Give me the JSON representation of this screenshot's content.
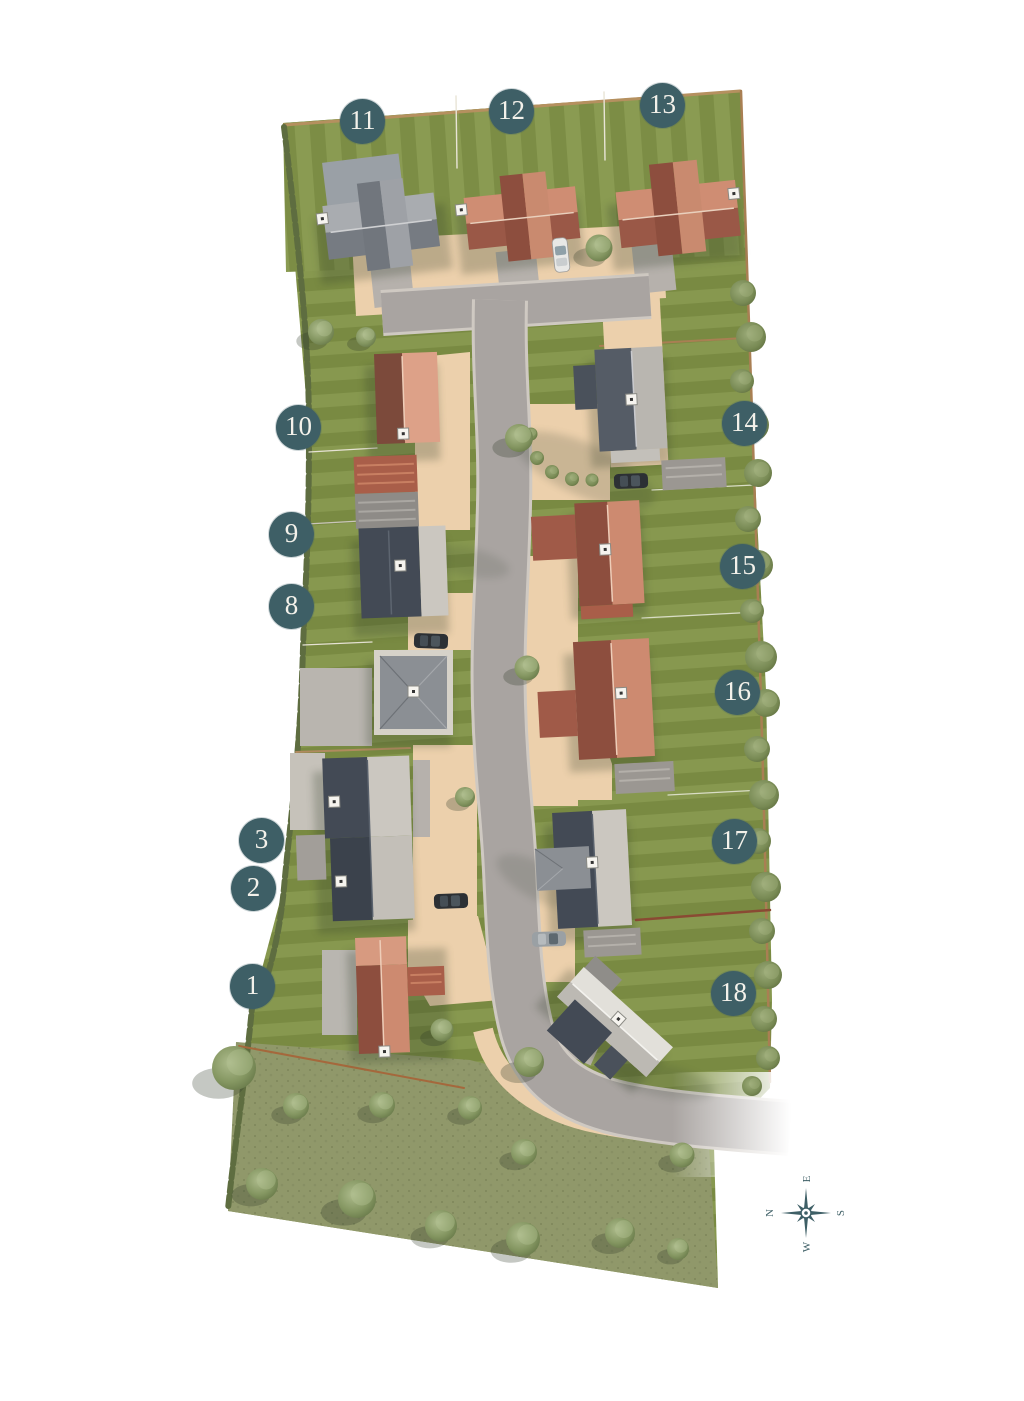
{
  "site_plan": {
    "plots": [
      {
        "number": "1",
        "x": 253,
        "y": 987
      },
      {
        "number": "2",
        "x": 254,
        "y": 889
      },
      {
        "number": "3",
        "x": 262,
        "y": 841
      },
      {
        "number": "8",
        "x": 292,
        "y": 607
      },
      {
        "number": "9",
        "x": 292,
        "y": 535
      },
      {
        "number": "10",
        "x": 299,
        "y": 428
      },
      {
        "number": "11",
        "x": 363,
        "y": 122
      },
      {
        "number": "12",
        "x": 512,
        "y": 112
      },
      {
        "number": "13",
        "x": 663,
        "y": 106
      },
      {
        "number": "14",
        "x": 745,
        "y": 424
      },
      {
        "number": "15",
        "x": 743,
        "y": 567
      },
      {
        "number": "16",
        "x": 738,
        "y": 693
      },
      {
        "number": "17",
        "x": 735,
        "y": 842
      },
      {
        "number": "18",
        "x": 734,
        "y": 994
      }
    ],
    "compass": {
      "north": "N",
      "east": "E",
      "south": "S",
      "west": "W"
    },
    "colors": {
      "plot_badge": "#3e5f66",
      "plot_badge_text": "#f3f1ea",
      "lawn": "#83944b",
      "meadow": "#90986a",
      "road": "#a9a4a1",
      "driveway": "#ecd0ac",
      "roof_terracotta_dark": "#8d4e3e",
      "roof_terracotta_light": "#cd8a70",
      "roof_slate_dark": "#3a4049",
      "roof_slate_light": "#525965",
      "roof_grey_dark": "#71767d",
      "roof_grey_light": "#a7aaae",
      "roof_white": "#e2e0da",
      "walls": "#d9d4ca",
      "tree": "#87996a",
      "hedge": "#64753f",
      "fence": "#a97f53",
      "compass": "#3e5f66"
    }
  }
}
